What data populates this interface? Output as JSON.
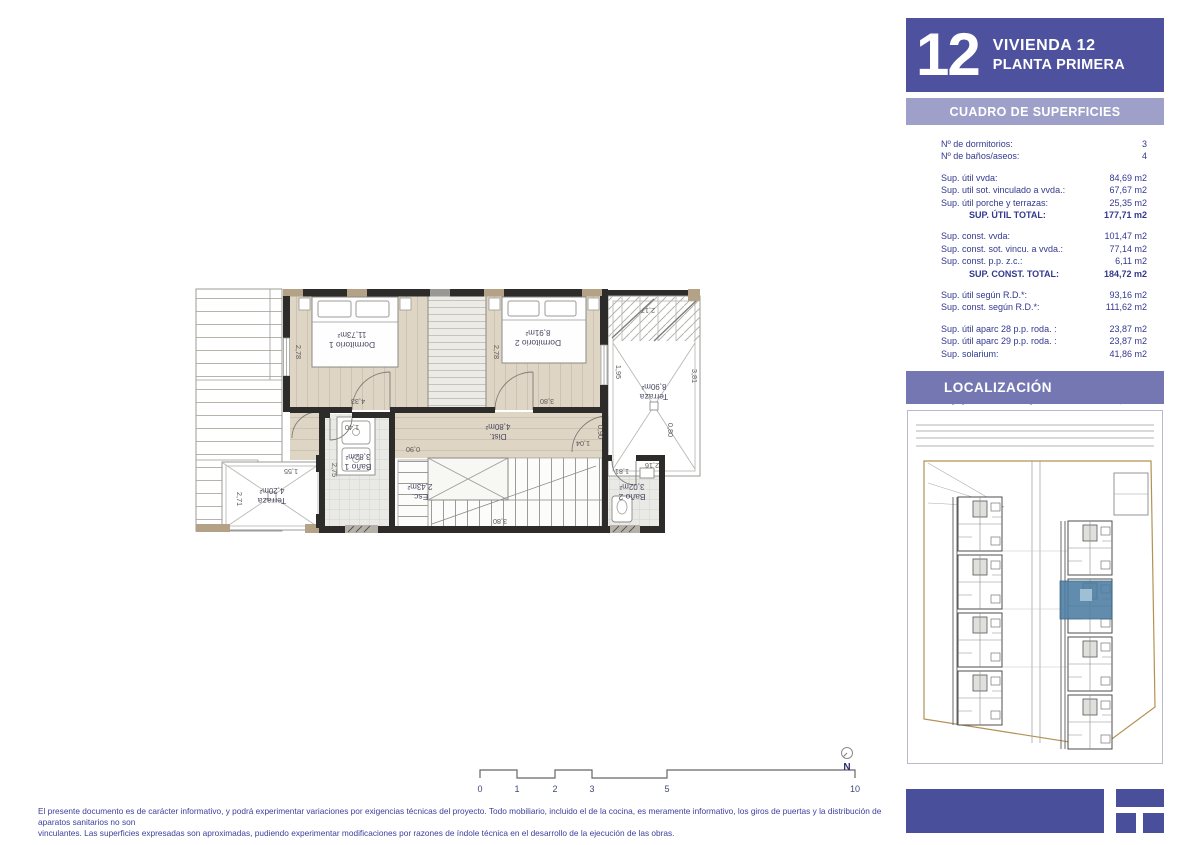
{
  "sidebar": {
    "header": {
      "number": "12",
      "line1": "VIVIENDA 12",
      "line2": "PLANTA PRIMERA"
    },
    "surfaces_title": "CUADRO DE SUPERFICIES",
    "localization_title": "LOCALIZACIÓN",
    "table": {
      "groups": [
        {
          "rows": [
            {
              "label": "Nº de dormitorios:",
              "value": "3"
            },
            {
              "label": "Nº de baños/aseos:",
              "value": "4"
            }
          ]
        },
        {
          "rows": [
            {
              "label": "Sup. útil vvda:",
              "value": "84,69 m2"
            },
            {
              "label": "Sup. util sot. vinculado a vvda.:",
              "value": "67,67 m2"
            },
            {
              "label": "Sup. útil porche y terrazas:",
              "value": "25,35 m2"
            },
            {
              "label": "SUP. ÚTIL TOTAL:",
              "value": "177,71 m2"
            }
          ]
        },
        {
          "rows": [
            {
              "label": "Sup. const. vvda:",
              "value": "101,47 m2"
            },
            {
              "label": "Sup. const. sot. vincu. a vvda.:",
              "value": "77,14 m2"
            },
            {
              "label": "Sup. const. p.p. z.c.:",
              "value": "6,11 m2"
            },
            {
              "label": "SUP. CONST. TOTAL:",
              "value": "184,72 m2"
            }
          ]
        },
        {
          "rows": [
            {
              "label": "Sup. útil según R.D.*:",
              "value": "93,16 m2"
            },
            {
              "label": "Sup. const. según R.D.*:",
              "value": "111,62 m2"
            }
          ]
        },
        {
          "rows": [
            {
              "label": "Sup. útil aparc 28 p.p. roda. :",
              "value": "23,87 m2"
            },
            {
              "label": "Sup. útil aparc 29 p.p. roda. :",
              "value": "23,87 m2"
            },
            {
              "label": "Sup. solarium:",
              "value": "41,86 m2"
            }
          ]
        },
        {
          "rows": [
            {
              "label": "Sup. zona privativa superior :",
              "value": "23,68 m2"
            },
            {
              "label": "Sup. zona privativa inferior:",
              "value": "36,00 m2"
            },
            {
              "label": "Sup. privativa total de parcela:",
              "value": "139,92 m2"
            }
          ]
        }
      ]
    }
  },
  "plan": {
    "rooms": {
      "dormitorio1": {
        "name": "Dormitorio 1",
        "area": "11,73m²"
      },
      "dormitorio2": {
        "name": "Dormitorio 2",
        "area": "8,91m²"
      },
      "terraza_right": {
        "name": "Terraza",
        "area": "8,90m²"
      },
      "terraza_left": {
        "name": "Terraza",
        "area": "4,20m²"
      },
      "bano1": {
        "name": "Baño 1",
        "area": "3,82m²"
      },
      "bano2": {
        "name": "Baño 2",
        "area": "3,02m²"
      },
      "dist": {
        "name": "Dist.",
        "area": "4,80m²"
      },
      "esc": {
        "name": "Esc.",
        "area": "2,43m²"
      }
    },
    "dims": [
      "2,78",
      "4,33",
      "2,78",
      "3,80",
      "2,17",
      "3,81",
      "1,95",
      "0,90",
      "1,04",
      "2,16",
      "1,55",
      "2,71",
      "2,75",
      "1,40",
      "0,90",
      "3,80",
      "1,81",
      "0,80"
    ]
  },
  "scalebar": {
    "labels": [
      "0",
      "1",
      "2",
      "3",
      "5",
      "10"
    ]
  },
  "north": {
    "label": "N"
  },
  "footer": {
    "line1": "El presente documento es de carácter informativo, y podrá experimentar variaciones por exigencias técnicas del proyecto. Todo mobiliario, incluido el de la cocina, es meramente informativo, los giros de puertas y la distribución de aparatos sanitarios no son",
    "line2": "vinculantes. Las superficies expresadas son aproximadas, pudiendo experimentar modificaciones por razones de índole técnica en el desarrollo de la ejecución de las obras."
  },
  "colors": {
    "accent": "#4e529e",
    "band_light": "#9fa0ca",
    "band_mid": "#7577b2",
    "logo": "#4a4f9b",
    "unit_highlight": "#4d7da2"
  }
}
